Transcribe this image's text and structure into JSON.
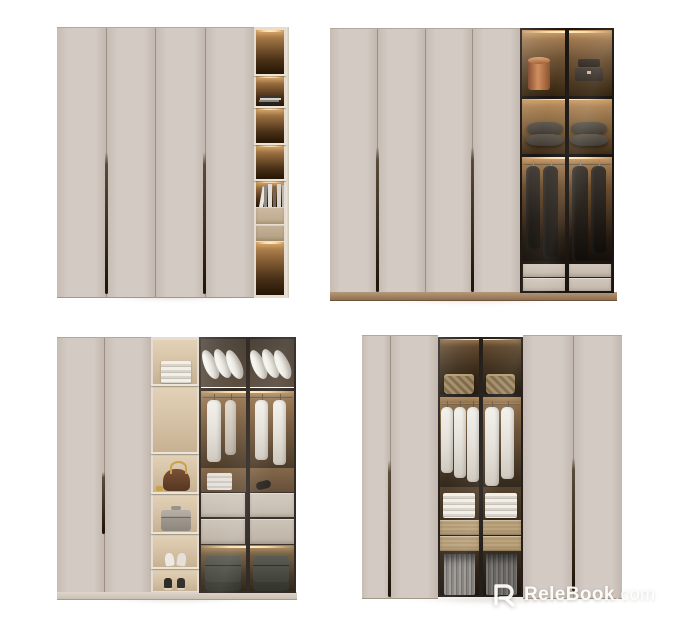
{
  "watermark": {
    "logo": "relebook-r-logo",
    "text_primary": "ReleBook",
    "text_suffix": ".com"
  },
  "colors": {
    "background": "#ffffff",
    "door_face": "#d3cac3",
    "handle_dark": "#211709",
    "frame_cream": "#e6ddd0",
    "shelf_cream": "#ece4d6",
    "column_back_tan": "#d9c6aa",
    "glass_frame": "#1a1511",
    "watermark_white": "#ffffff"
  },
  "scene": {
    "description": "Four modern greige wardrobe cabinets with warm LED-lit interiors, shown as a 2x2 product collage on white",
    "wardrobes": [
      {
        "id": "top-left",
        "closed_doors": 4,
        "open_sections": [
          "LED-lit shelf column",
          "flat book stack",
          "upright books",
          "two beige drawers"
        ]
      },
      {
        "id": "top-right",
        "closed_doors": 4,
        "open_sections": [
          "two glass doors",
          "copper canister",
          "dark storage boxes",
          "two dark pillows per bay",
          "hanging dark garments",
          "beige drawers",
          "wood plinth"
        ]
      },
      {
        "id": "bottom-left",
        "closed_doors": 2,
        "open_sections": [
          "tan shelf column",
          "folded clothes",
          "brown handbag",
          "grey vanity case",
          "white heels",
          "dark sneakers",
          "glass doors",
          "white pillows",
          "hanging shirts",
          "organizer box",
          "hair dryer",
          "grey drawers",
          "two dark suitcases"
        ]
      },
      {
        "id": "bottom-right",
        "closed_doors": 4,
        "open_sections": [
          "central glass doors",
          "woven baskets",
          "hanging white shirts",
          "folded stacks",
          "oak drawers",
          "hanging trousers"
        ]
      }
    ]
  }
}
